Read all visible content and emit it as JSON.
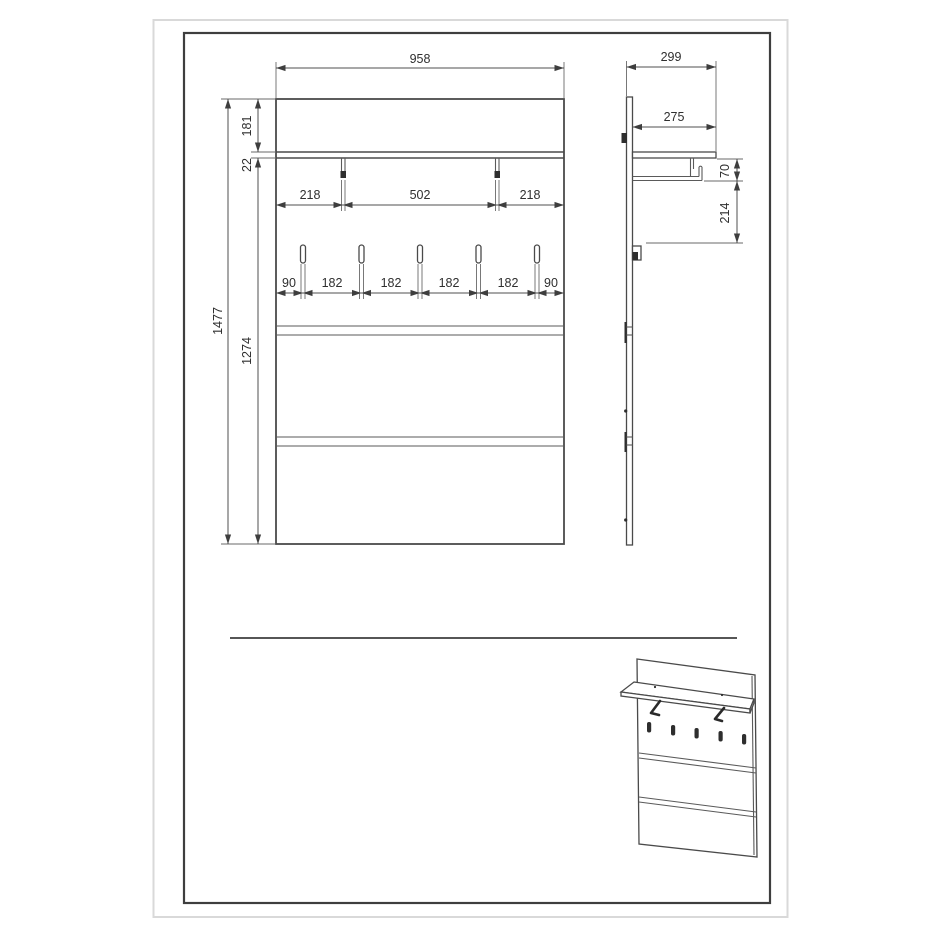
{
  "drawing": {
    "type": "furniture-dimension-drawing",
    "subject": "wall-mounted coat rack panel with shelf and hooks",
    "style": {
      "line_color": "#3e3e3e",
      "dim_line_color": "#4f4f4f",
      "text_color": "#2f2f2f",
      "outer_frame_color": "#d9d9d9",
      "background": "#ffffff"
    },
    "front": {
      "width": "958",
      "height": "1477",
      "upper": "181",
      "shelf_thickness": "22",
      "lower": "1274",
      "bracket_spacing": [
        "218",
        "502",
        "218"
      ],
      "hook_spacing": [
        "90",
        "182",
        "182",
        "182",
        "182",
        "90"
      ]
    },
    "side": {
      "depth": "299",
      "shelf_depth": "275",
      "rail_offset": "70",
      "hook_offset": "214"
    }
  }
}
